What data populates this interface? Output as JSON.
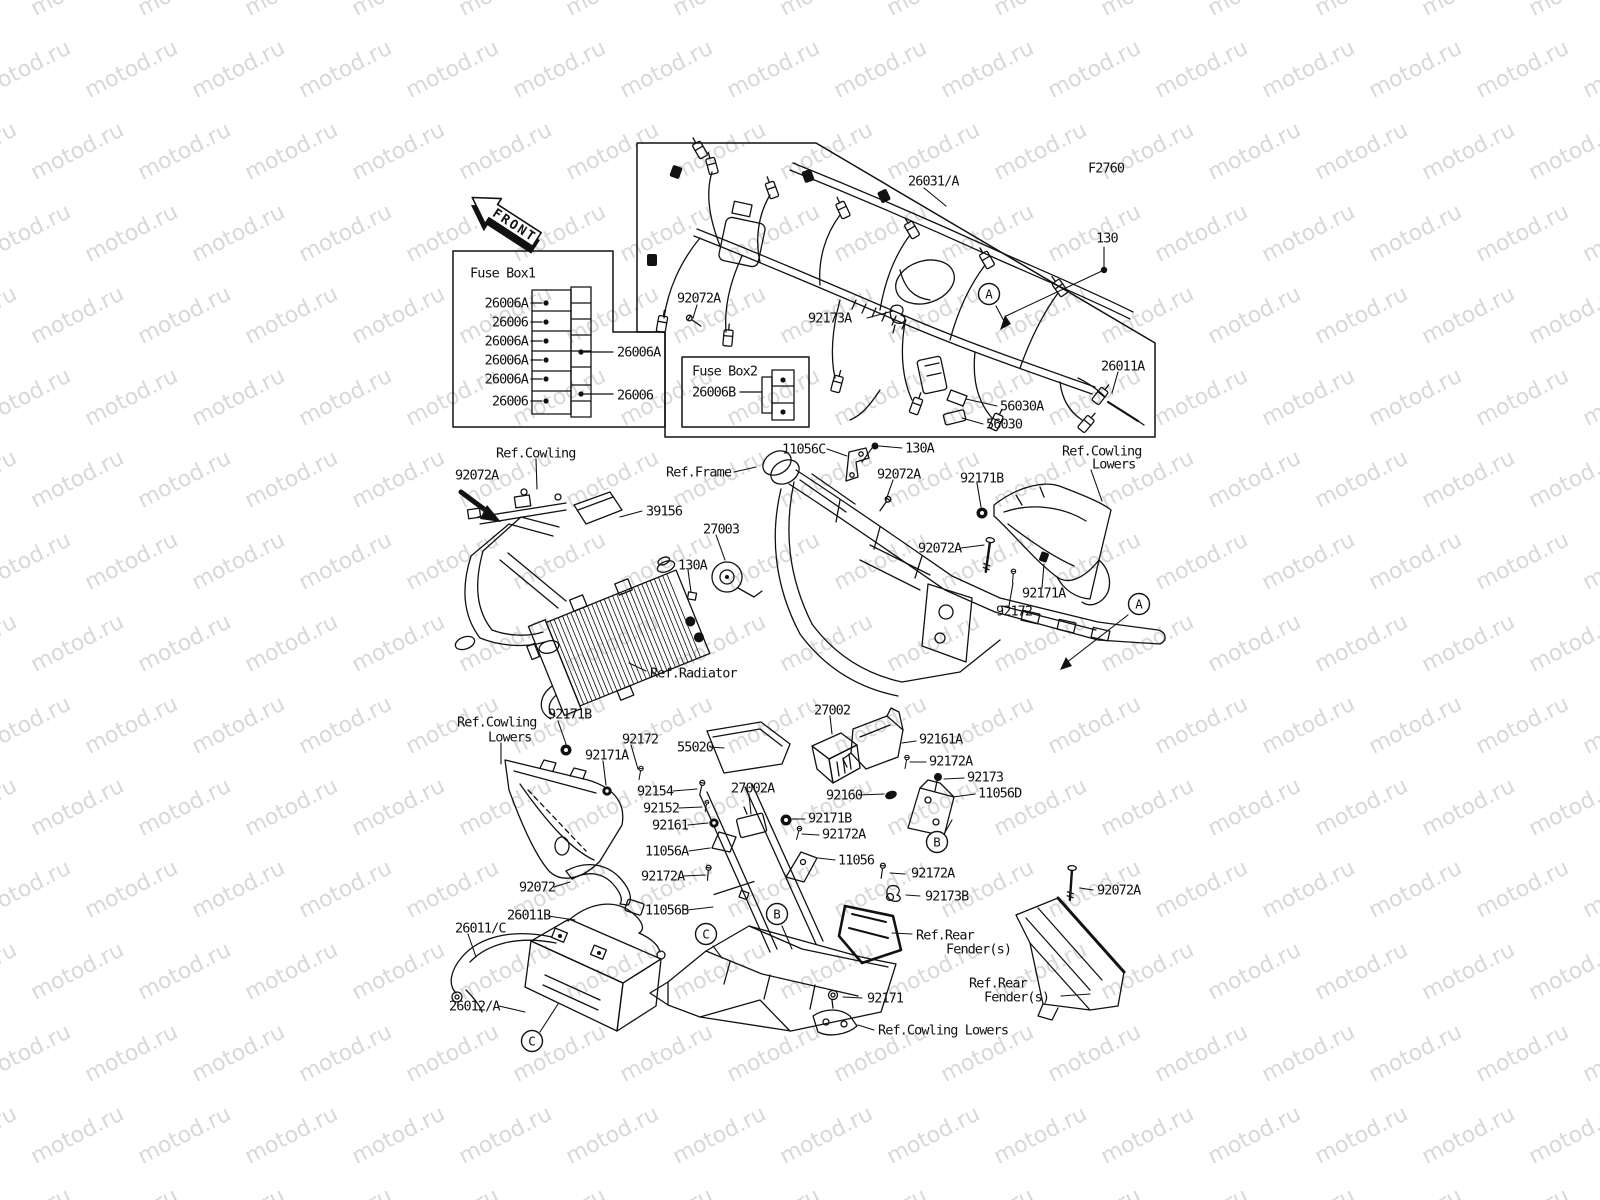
{
  "watermark": {
    "text": "motod.ru",
    "color": "#d8d8d8"
  },
  "front_arrow": {
    "text": "FRONT"
  },
  "colors": {
    "line": "#111111",
    "background": "#ffffff"
  },
  "fuse_box1": {
    "title": "Fuse Box1"
  },
  "fuse_box2": {
    "title": "Fuse Box2"
  },
  "callouts": [
    {
      "name": "fusebox1-title",
      "text": "Fuse Box1",
      "x": 470,
      "y": 273
    },
    {
      "name": "fuse1-left-1",
      "text": "26006A",
      "x": 528,
      "y": 303,
      "anchor": "end"
    },
    {
      "name": "fuse1-left-2",
      "text": "26006",
      "x": 528,
      "y": 322,
      "anchor": "end"
    },
    {
      "name": "fuse1-left-3",
      "text": "26006A",
      "x": 528,
      "y": 341,
      "anchor": "end"
    },
    {
      "name": "fuse1-left-4",
      "text": "26006A",
      "x": 528,
      "y": 360,
      "anchor": "end"
    },
    {
      "name": "fuse1-left-5",
      "text": "26006A",
      "x": 528,
      "y": 379,
      "anchor": "end"
    },
    {
      "name": "fuse1-left-6",
      "text": "26006",
      "x": 528,
      "y": 401,
      "anchor": "end"
    },
    {
      "name": "fuse1-right-1",
      "text": "26006A",
      "x": 617,
      "y": 352
    },
    {
      "name": "fuse1-right-2",
      "text": "26006",
      "x": 617,
      "y": 395
    },
    {
      "name": "fusebox2-title",
      "text": "Fuse Box2",
      "x": 692,
      "y": 371
    },
    {
      "name": "26006b",
      "text": "26006B",
      "x": 692,
      "y": 392
    },
    {
      "name": "26031a",
      "text": "26031/A",
      "x": 908,
      "y": 181
    },
    {
      "name": "f2760",
      "text": "F2760",
      "x": 1088,
      "y": 168
    },
    {
      "name": "130",
      "text": "130",
      "x": 1096,
      "y": 238
    },
    {
      "name": "92072a-1",
      "text": "92072A",
      "x": 677,
      "y": 298
    },
    {
      "name": "92173a",
      "text": "92173A",
      "x": 808,
      "y": 318
    },
    {
      "name": "26011a",
      "text": "26011A",
      "x": 1101,
      "y": 366
    },
    {
      "name": "56030a",
      "text": "56030A",
      "x": 1000,
      "y": 406
    },
    {
      "name": "56030",
      "text": "56030",
      "x": 986,
      "y": 424
    },
    {
      "name": "ref-cowling",
      "text": "Ref.Cowling",
      "x": 496,
      "y": 453
    },
    {
      "name": "92072a-2",
      "text": "92072A",
      "x": 455,
      "y": 475
    },
    {
      "name": "39156",
      "text": "39156",
      "x": 646,
      "y": 511
    },
    {
      "name": "27003",
      "text": "27003",
      "x": 703,
      "y": 529
    },
    {
      "name": "130a-2",
      "text": "130A",
      "x": 678,
      "y": 565
    },
    {
      "name": "ref-frame",
      "text": "Ref.Frame",
      "x": 666,
      "y": 472
    },
    {
      "name": "11056c",
      "text": "11056C",
      "x": 782,
      "y": 449
    },
    {
      "name": "130a-1",
      "text": "130A",
      "x": 905,
      "y": 448
    },
    {
      "name": "92072a-3",
      "text": "92072A",
      "x": 877,
      "y": 474
    },
    {
      "name": "92171b-1",
      "text": "92171B",
      "x": 960,
      "y": 478
    },
    {
      "name": "ref-cowl-lowers-tr1",
      "text": "Ref.Cowling",
      "x": 1062,
      "y": 451
    },
    {
      "name": "ref-cowl-lowers-tr2",
      "text": "Lowers",
      "x": 1092,
      "y": 464
    },
    {
      "name": "92072a-4",
      "text": "92072A",
      "x": 918,
      "y": 548
    },
    {
      "name": "92171a-1",
      "text": "92171A",
      "x": 1022,
      "y": 593
    },
    {
      "name": "92172-1",
      "text": "92172",
      "x": 996,
      "y": 611
    },
    {
      "name": "ref-radiator",
      "text": "Ref.Radiator",
      "x": 650,
      "y": 673
    },
    {
      "name": "27002",
      "text": "27002",
      "x": 814,
      "y": 710
    },
    {
      "name": "55020",
      "text": "55020",
      "x": 677,
      "y": 747
    },
    {
      "name": "92161a",
      "text": "92161A",
      "x": 919,
      "y": 739
    },
    {
      "name": "92172a-5",
      "text": "92172A",
      "x": 929,
      "y": 761
    },
    {
      "name": "92173",
      "text": "92173",
      "x": 967,
      "y": 777
    },
    {
      "name": "11056d",
      "text": "11056D",
      "x": 978,
      "y": 793
    },
    {
      "name": "92160",
      "text": "92160",
      "x": 826,
      "y": 795
    },
    {
      "name": "92154",
      "text": "92154",
      "x": 637,
      "y": 791
    },
    {
      "name": "92152",
      "text": "92152",
      "x": 643,
      "y": 808
    },
    {
      "name": "92161",
      "text": "92161",
      "x": 652,
      "y": 825
    },
    {
      "name": "27002a",
      "text": "27002A",
      "x": 731,
      "y": 788
    },
    {
      "name": "92171b-2",
      "text": "92171B",
      "x": 808,
      "y": 818
    },
    {
      "name": "92172a-6",
      "text": "92172A",
      "x": 822,
      "y": 834
    },
    {
      "name": "11056a",
      "text": "11056A",
      "x": 645,
      "y": 851
    },
    {
      "name": "11056",
      "text": "11056",
      "x": 838,
      "y": 860
    },
    {
      "name": "92171b-3",
      "text": "92171B",
      "x": 548,
      "y": 714
    },
    {
      "name": "92172-2",
      "text": "92172",
      "x": 622,
      "y": 739
    },
    {
      "name": "92171a-2",
      "text": "92171A",
      "x": 585,
      "y": 755
    },
    {
      "name": "ref-cowl-lowers-l1",
      "text": "Ref.Cowling",
      "x": 457,
      "y": 722
    },
    {
      "name": "ref-cowl-lowers-l2",
      "text": "Lowers",
      "x": 488,
      "y": 737
    },
    {
      "name": "92072",
      "text": "92072",
      "x": 519,
      "y": 887
    },
    {
      "name": "26011b",
      "text": "26011B",
      "x": 507,
      "y": 915
    },
    {
      "name": "26011c",
      "text": "26011/C",
      "x": 455,
      "y": 928
    },
    {
      "name": "26012a",
      "text": "26012/A",
      "x": 449,
      "y": 1006
    },
    {
      "name": "92172a-7",
      "text": "92172A",
      "x": 641,
      "y": 876
    },
    {
      "name": "11056b",
      "text": "11056B",
      "x": 645,
      "y": 910
    },
    {
      "name": "92172a-8",
      "text": "92172A",
      "x": 911,
      "y": 873
    },
    {
      "name": "92173b",
      "text": "92173B",
      "x": 925,
      "y": 896
    },
    {
      "name": "ref-rear-fender-c1",
      "text": "Ref.Rear",
      "x": 916,
      "y": 935
    },
    {
      "name": "ref-rear-fender-c2",
      "text": "Fender(s)",
      "x": 946,
      "y": 949
    },
    {
      "name": "ref-rear-fender-r1",
      "text": "Ref.Rear",
      "x": 969,
      "y": 983
    },
    {
      "name": "ref-rear-fender-r2",
      "text": "Fender(s)",
      "x": 984,
      "y": 997
    },
    {
      "name": "92072a-9",
      "text": "92072A",
      "x": 1097,
      "y": 890
    },
    {
      "name": "92171",
      "text": "92171",
      "x": 867,
      "y": 998
    },
    {
      "name": "ref-cowl-lowers-b",
      "text": "Ref.Cowling Lowers",
      "x": 878,
      "y": 1030
    }
  ],
  "markers": [
    {
      "letter": "A",
      "x": 989,
      "y": 294
    },
    {
      "letter": "A",
      "x": 1139,
      "y": 604
    },
    {
      "letter": "B",
      "x": 937,
      "y": 842
    },
    {
      "letter": "B",
      "x": 777,
      "y": 914
    },
    {
      "letter": "C",
      "x": 706,
      "y": 934
    },
    {
      "letter": "C",
      "x": 532,
      "y": 1041
    }
  ]
}
